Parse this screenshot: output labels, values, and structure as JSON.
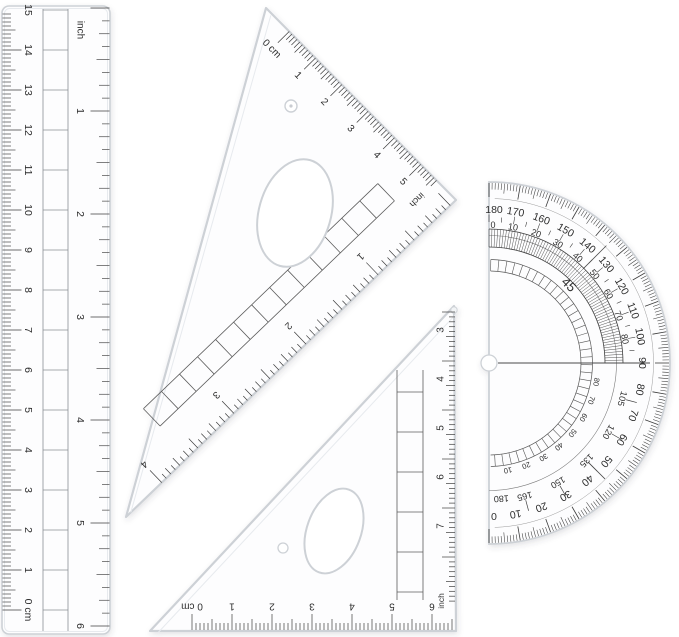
{
  "colors": {
    "background": "#ffffff",
    "plastic_fill": "#fdfdfe",
    "plastic_edge": "#cdd1d6",
    "bevel": "#e7eaee",
    "marking": "#2d2d2d",
    "tick": "#3c3c3c",
    "thin_line": "#777777",
    "shadow": "#3b4250"
  },
  "ruler": {
    "cm_labels": [
      "0 cm",
      "1",
      "2",
      "3",
      "4",
      "5",
      "6",
      "7",
      "8",
      "9",
      "10",
      "11",
      "12",
      "13",
      "14",
      "15"
    ],
    "inch_unit_label": "inch",
    "inch_labels": [
      "1",
      "2",
      "3",
      "4",
      "5",
      "6"
    ]
  },
  "large_triangle": {
    "cm_labels": [
      "0 cm",
      "1",
      "2",
      "3",
      "4",
      "5"
    ],
    "inch_unit_label": "inch",
    "inch_labels": [
      "1",
      "2",
      "3",
      "4"
    ]
  },
  "small_triangle": {
    "bottom_labels": [
      "0 cm",
      "1",
      "2",
      "3",
      "4",
      "5",
      "6"
    ],
    "right_labels": [
      "3",
      "4",
      "5",
      "6",
      "7"
    ],
    "right_unit_label": "inch"
  },
  "protractor": {
    "outer_labels": [
      "180",
      "170",
      "160",
      "150",
      "140",
      "130",
      "120",
      "110",
      "100",
      "90",
      "80",
      "70",
      "60",
      "50",
      "40",
      "30",
      "20",
      "10",
      "0"
    ],
    "inner_top_labels": [
      "0",
      "10",
      "20",
      "30",
      "40",
      "50",
      "60",
      "70",
      "80"
    ],
    "inner_bottom_labels": [
      "105",
      "120",
      "135",
      "150",
      "165"
    ],
    "inner_bottom_end_label": "180",
    "inner_small_labels": [
      "10",
      "20",
      "30",
      "40",
      "50",
      "60",
      "70",
      "80"
    ],
    "diagonal_label": "45"
  }
}
